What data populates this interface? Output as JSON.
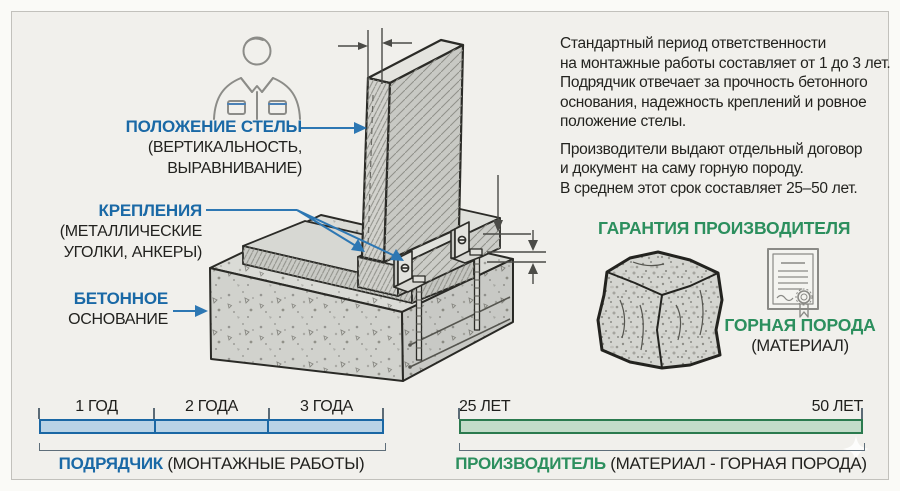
{
  "diagram": {
    "labels": {
      "position": {
        "title": "ПОЛОЖЕНИЕ СТЕЛЫ",
        "line1": "(ВЕРТИКАЛЬНОСТЬ,",
        "line2": "ВЫРАВНИВАНИЕ)"
      },
      "fixings": {
        "title": "КРЕПЛЕНИЯ",
        "line1": "(МЕТАЛЛИЧЕСКИЕ",
        "line2": "УГОЛКИ, АНКЕРЫ)"
      },
      "foundation": {
        "title": "БЕТОННОЕ",
        "line1": "ОСНОВАНИЕ"
      }
    },
    "icons": {
      "worker-icon": "outlined installer/worker bust",
      "stela-drawing": "hatched stone slab on pedestal",
      "concrete-base-drawing": "speckled concrete foundation block with anchors and angle brackets",
      "rock-icon": "granite block illustration",
      "certificate-icon": "document with rosette seal and ribbon",
      "sparkle-watermark": "four-point star"
    }
  },
  "info": {
    "p1_lines": [
      "Стандартный период ответственности",
      "на монтажные работы составляет от 1 до 3 лет.",
      "Подрядчик отвечает за прочность бетонного",
      "основания, надежность креплений и ровное",
      "положение стелы."
    ],
    "p2_lines": [
      "Производители выдают отдельный договор",
      "и документ на саму горную породу.",
      "В среднем этот срок составляет 25–50 лет."
    ]
  },
  "guarantee": {
    "heading": "ГАРАНТИЯ ПРОИЗВОДИТЕЛЯ",
    "material_title": "ГОРНАЯ ПОРОДА",
    "material_sub": "(МАТЕРИАЛ)"
  },
  "timelines": {
    "contractor": {
      "segments": [
        "1 ГОД",
        "2 ГОДА",
        "3 ГОДА"
      ],
      "caption_bold": "ПОДРЯДЧИК",
      "caption_rest": "(МОНТАЖНЫЕ РАБОТЫ)",
      "bar_fill": "#b9d3e6",
      "bar_border": "#1a67a4",
      "years": [
        1,
        3
      ]
    },
    "manufacturer": {
      "start": "25 ЛЕТ",
      "end": "50 ЛЕТ",
      "caption_bold": "ПРОИЗВОДИТЕЛЬ",
      "caption_rest": "(МАТЕРИАЛ - ГОРНАЯ ПОРОДА)",
      "bar_fill": "#c3dcc9",
      "bar_border": "#2b7a4e",
      "years": [
        25,
        50
      ]
    }
  },
  "colors": {
    "accent_blue": "#1a69a6",
    "accent_green": "#2c8f5e",
    "text": "#23231f",
    "background": "#f1f0ec",
    "frame": "#c2c1bc"
  }
}
